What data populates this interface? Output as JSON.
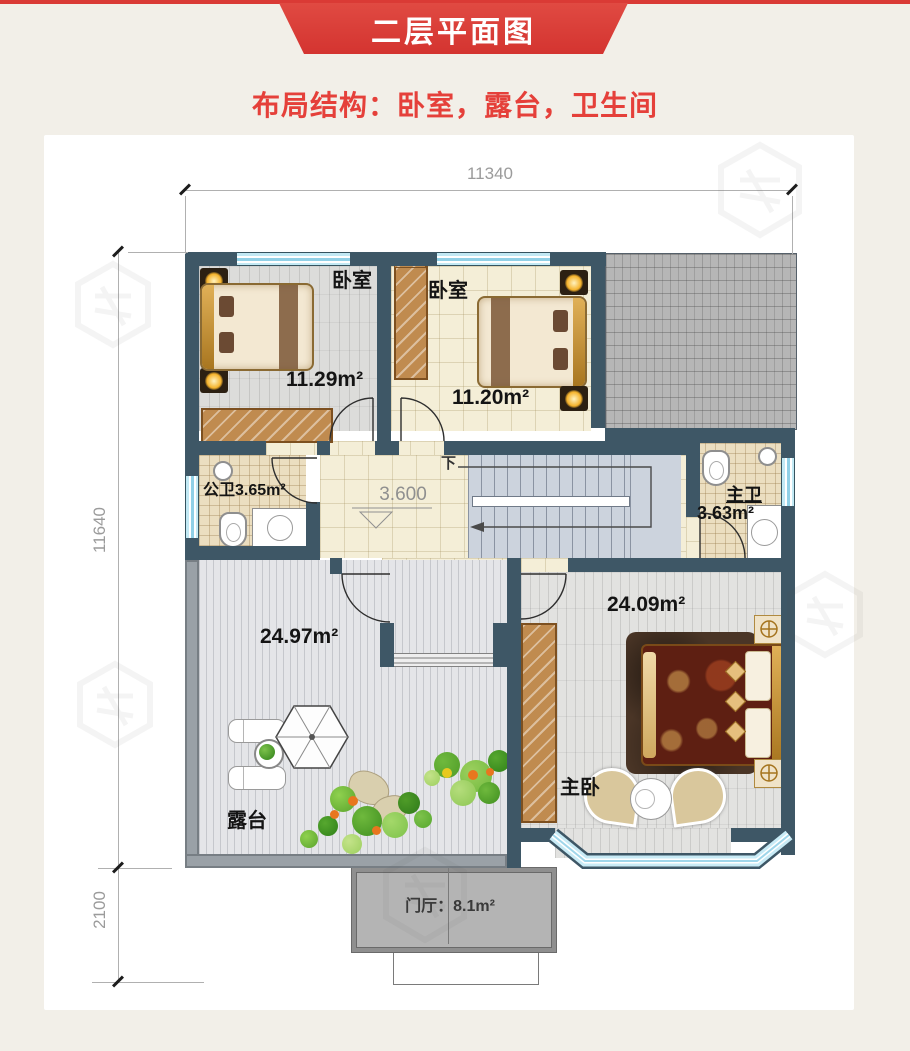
{
  "banner": {
    "title": "二层平面图"
  },
  "subtitle": "布局结构：卧室，露台，卫生间",
  "dimensions": {
    "top": "11340",
    "left": "11640",
    "bottom_left": "2100"
  },
  "stairs": {
    "down_label": "下",
    "elevation_label": "3.600"
  },
  "rooms": {
    "bedroom1": {
      "label": "卧室",
      "area": "11.29m²"
    },
    "bedroom2": {
      "label": "卧室",
      "area": "11.20m²"
    },
    "public_bath": {
      "label": "公卫",
      "area": "3.65m²"
    },
    "master_bath": {
      "label": "主卫",
      "area": "3.63m²"
    },
    "master_bedroom": {
      "label": "主卧",
      "area": "24.09m²"
    },
    "terrace": {
      "label": "露台",
      "area": "24.97m²"
    },
    "foyer": {
      "label": "门厅：8.1m²"
    }
  },
  "colors": {
    "banner_red": "#da3a35",
    "accent_text_red": "#e5403a",
    "wall": "#3e5766",
    "window_blue": "#a9dcee",
    "dimension_gray": "#9b9b9b",
    "roof_gray": "#b6b6b6"
  }
}
